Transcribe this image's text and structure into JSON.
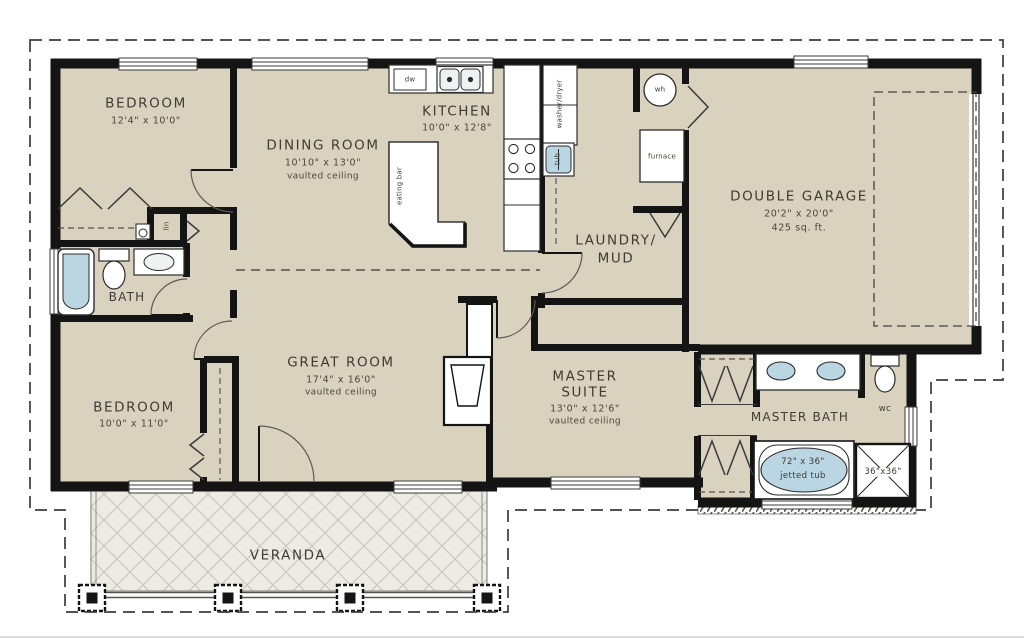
{
  "plan": {
    "rooms": {
      "bedroom1": {
        "name": "BEDROOM",
        "dims": "12'4\" x 10'0\""
      },
      "dining": {
        "name": "DINING ROOM",
        "dims": "10'10\" x 13'0\"",
        "note": "vaulted ceiling"
      },
      "kitchen": {
        "name": "KITCHEN",
        "dims": "10'0\" x 12'8\""
      },
      "laundry": {
        "line1": "LAUNDRY/",
        "line2": "MUD"
      },
      "garage": {
        "name": "DOUBLE GARAGE",
        "dims": "20'2\" x 20'0\"",
        "area": "425 sq. ft."
      },
      "great": {
        "name": "GREAT ROOM",
        "dims": "17'4\" x 16'0\"",
        "note": "vaulted ceiling"
      },
      "bedroom2": {
        "name": "BEDROOM",
        "dims": "10'0\" x 11'0\""
      },
      "master": {
        "line1": "MASTER",
        "line2": "SUITE",
        "dims": "13'0\" x 12'6\"",
        "note": "vaulted ceiling"
      },
      "masterbath": {
        "name": "MASTER BATH"
      },
      "bath": {
        "name": "BATH"
      },
      "wc": {
        "name": "wc"
      },
      "veranda": {
        "name": "VERANDA"
      }
    },
    "fixtures": {
      "dishwasher": "dw",
      "linen": "lin",
      "water_heater": "wh",
      "furnace": "furnace",
      "washer_dryer": "washer/dryer",
      "laundry_tub": "tub",
      "eating_bar": "eating bar",
      "jetted_tub_size": "72\" x 36\"",
      "jetted_tub": "jetted tub",
      "shower_size": "36\"x36\""
    },
    "colors": {
      "floor": "#d8d2bf",
      "wall": "#141414",
      "veranda_floor": "#ecebe4",
      "water": "#b9d6e2",
      "text": "#45423a"
    }
  }
}
